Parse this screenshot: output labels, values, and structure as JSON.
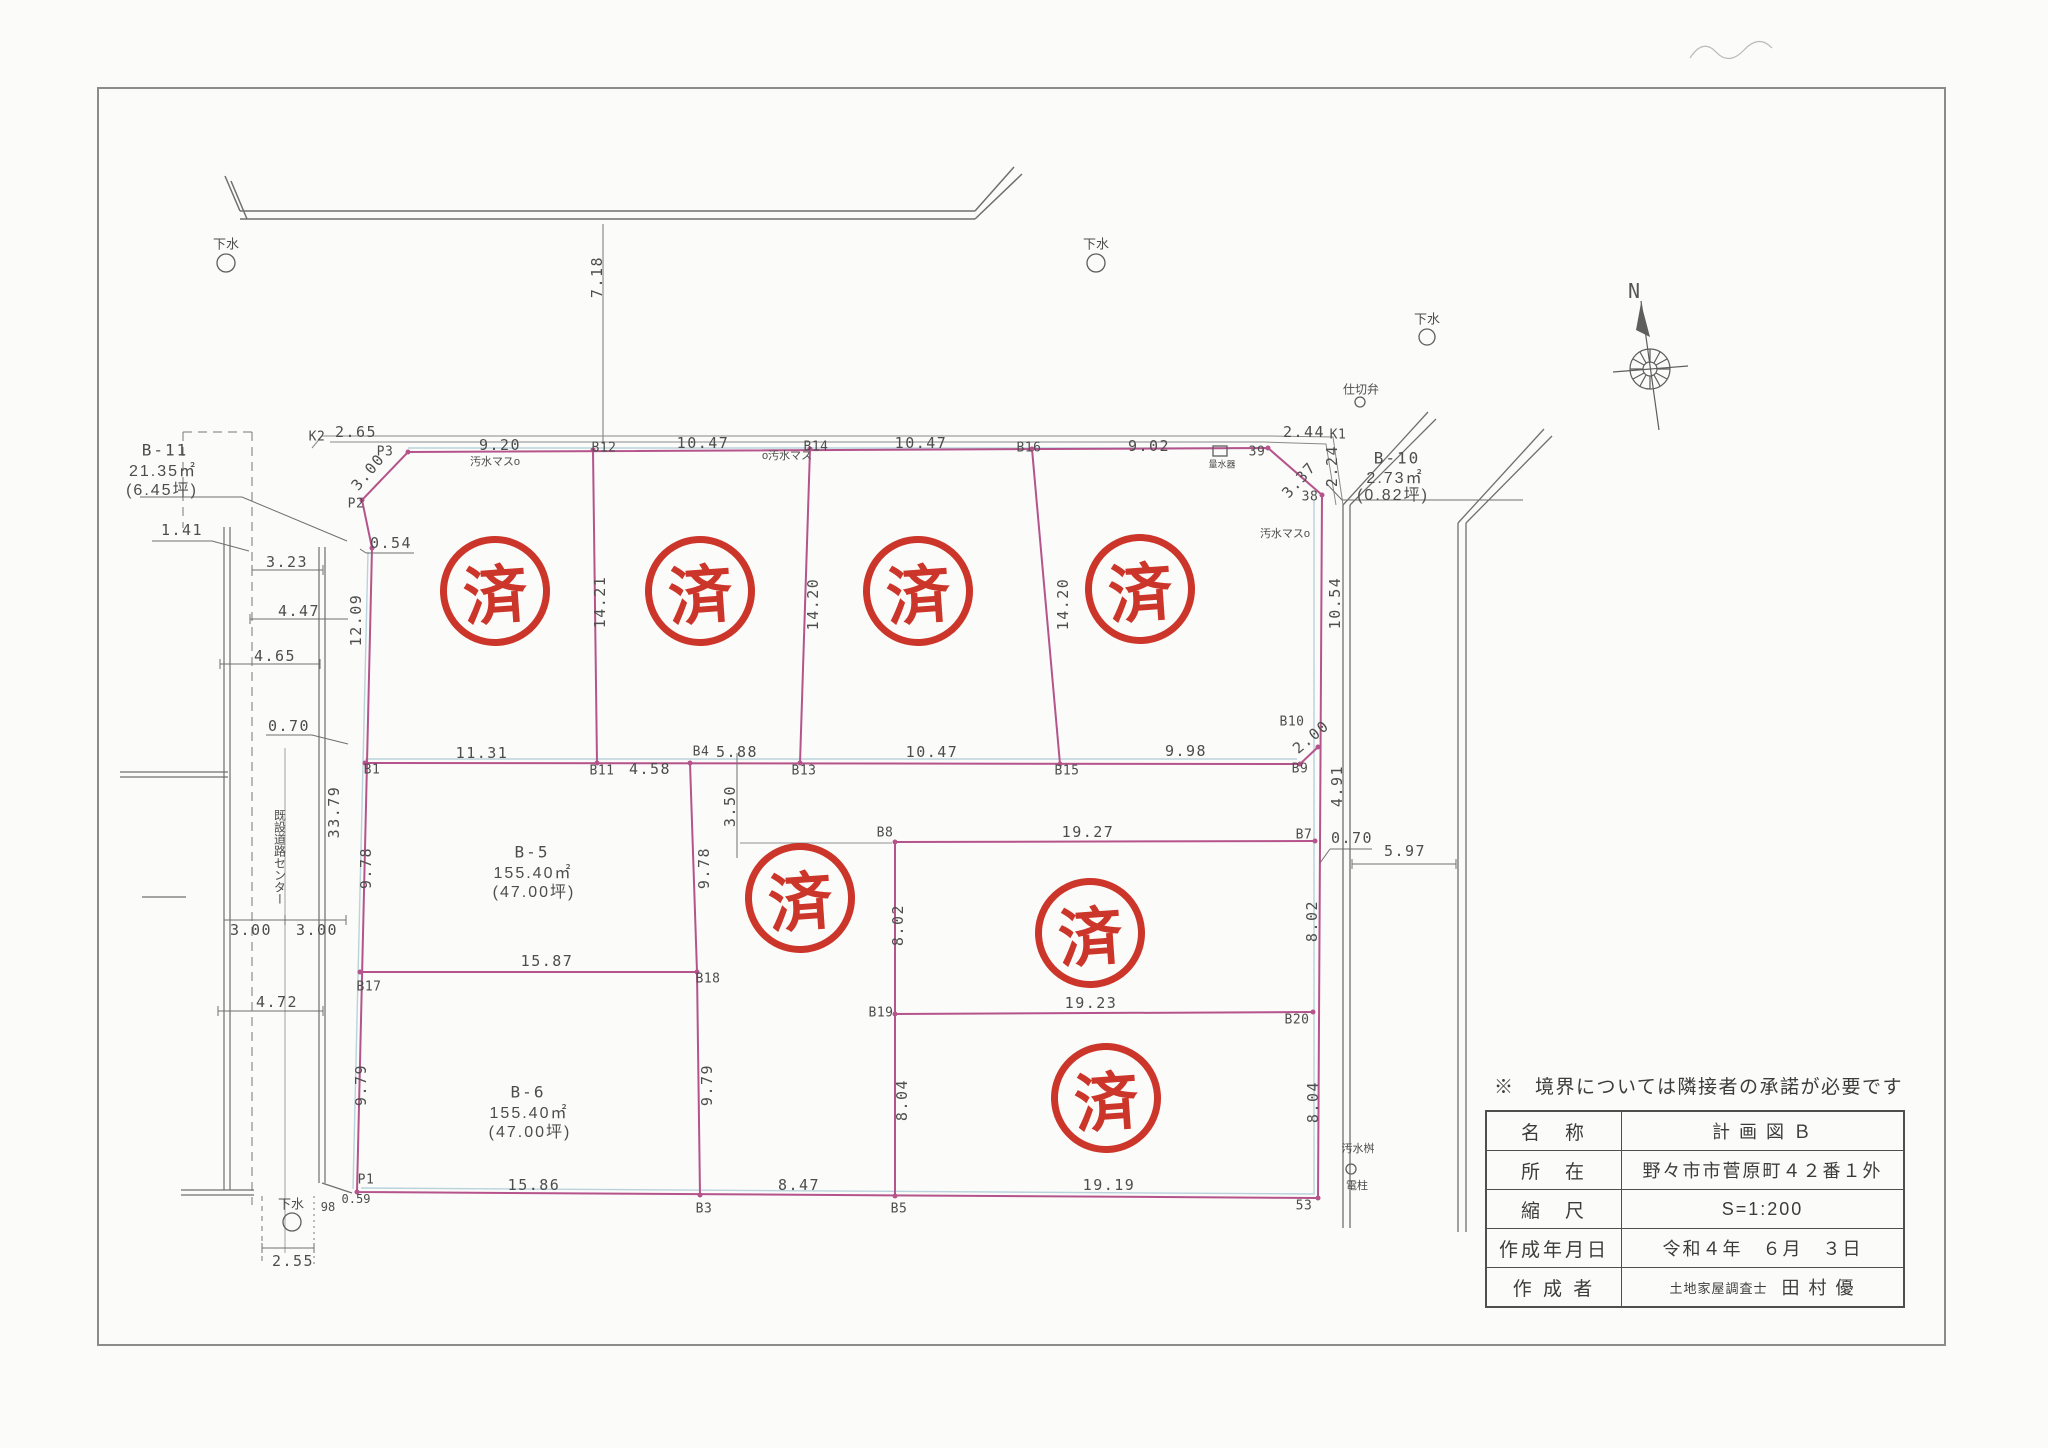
{
  "stamps": {
    "glyph": "済"
  },
  "compass": {
    "north": "N"
  },
  "note": "※　境界については隣接者の承諾が必要です",
  "title_block": {
    "rows": [
      {
        "label": "名　称",
        "value": "計 画 図 Ｂ"
      },
      {
        "label": "所　在",
        "value": "野々市市菅原町４２番１外"
      },
      {
        "label": "縮　尺",
        "value": "S=1:200"
      },
      {
        "label": "作成年月日",
        "value": "令和４年　６月　３日"
      },
      {
        "label": "作 成 者",
        "value": "土地家屋調査士",
        "value2": "田 村 優"
      }
    ]
  },
  "parcels": {
    "b11": {
      "name": "B-11",
      "area": "21.35㎡",
      "tsubo": "(6.45坪)"
    },
    "b10": {
      "name": "B-10",
      "area": "2.73㎡",
      "tsubo": "(0.82坪)"
    },
    "b5": {
      "name": "B-5",
      "area": "155.40㎡",
      "tsubo": "(47.00坪)"
    },
    "b6": {
      "name": "B-6",
      "area": "155.40㎡",
      "tsubo": "(47.00坪)"
    }
  },
  "points": {
    "k2": "K2",
    "p3": "P3",
    "p2": "P2",
    "p1": "P1",
    "k1": "K1",
    "n38": "38",
    "n39": "39",
    "n53": "53",
    "n98": "98",
    "b1": "B1",
    "b3": "B3",
    "b4": "B4",
    "b5": "B5",
    "b7": "B7",
    "b8": "B8",
    "b9": "B9",
    "b10": "B10",
    "b11": "B11",
    "b12": "B12",
    "b13": "B13",
    "b14": "B14",
    "b15": "B15",
    "b16": "B16",
    "b17": "B17",
    "b18": "B18",
    "b19": "B19",
    "b20": "B20"
  },
  "dims": {
    "road_offset": "7.18",
    "k2_p3": "2.65",
    "p3_chamfer": "3.00",
    "p2_kink": "0.54",
    "top": [
      "9.20",
      "10.47",
      "10.47",
      "9.02"
    ],
    "k1_a": "2.44",
    "k1_b": "2.24",
    "tr_chamfer": "3.37",
    "row1_depths": [
      "12.09",
      "14.21",
      "14.20",
      "14.20",
      "10.54"
    ],
    "left": [
      "1.41",
      "3.23",
      "4.47",
      "4.65",
      "0.70",
      "33.79",
      "4.72",
      "2.55"
    ],
    "road_half": [
      "3.00",
      "3.00"
    ],
    "mid": [
      "11.31",
      "4.58",
      "5.88",
      "10.47",
      "9.98"
    ],
    "b9_chamfer": "2.00",
    "b10_b7": "4.91",
    "b5_w": "15.87",
    "b5_d": "9.78",
    "b5_d2": "9.78",
    "b6_w": "15.86",
    "b6_d": "9.79",
    "b6_d2": "9.79",
    "notch": "3.50",
    "center_w": "8.47",
    "e_top": "19.27",
    "e_d1": "8.02",
    "e_d2": "8.02",
    "e_mid": "19.23",
    "e_d3": "8.04",
    "e_d4": "8.04",
    "e_bot": "19.19",
    "p1_jog": "0.59",
    "gap": "0.70",
    "road_w": "5.97"
  },
  "ann": {
    "gesui": "下水",
    "shikiriben": "仕切弁",
    "osui_l": "汚水マスo",
    "osui_c": "o汚水マス",
    "osui_r": "汚水マスo",
    "ryosuiki": "量水器",
    "osui_b": "汚水桝",
    "denchu": "電柱",
    "road_center": "既設道路センター"
  }
}
